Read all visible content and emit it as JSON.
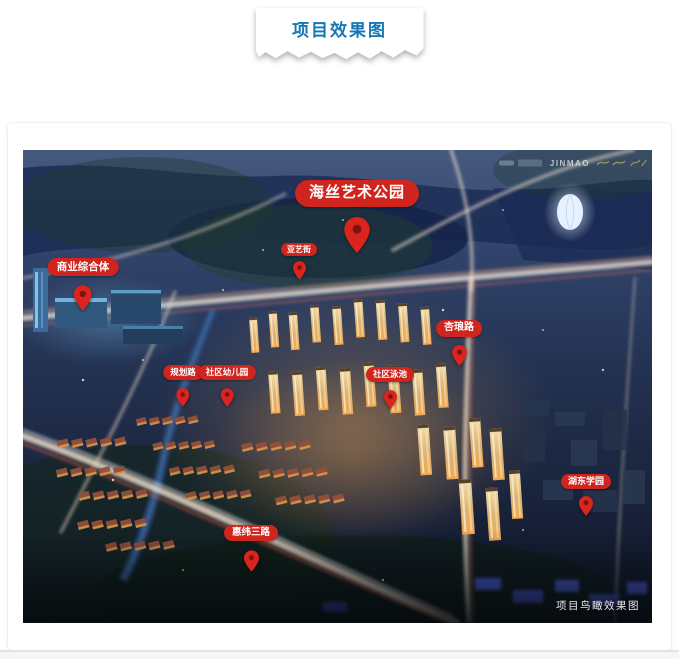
{
  "header": {
    "tab_label": "项目效果图",
    "accent_color": "#1577b2"
  },
  "rendering": {
    "watermark_brand": "JINMAO",
    "caption": "项目鸟瞰效果图",
    "pin_color": "#da251f",
    "badge_color": "#d0241e",
    "pins": [
      {
        "id": "haisi-art-park",
        "label": "海丝艺术公园"
      },
      {
        "id": "commercial-complex",
        "label": "商业综合体"
      },
      {
        "id": "yayi-street",
        "label": "亚艺街"
      },
      {
        "id": "xinglang-road",
        "label": "杏琅路"
      },
      {
        "id": "planned-road",
        "label": "规划路"
      },
      {
        "id": "community-kindergarten",
        "label": "社区幼儿园"
      },
      {
        "id": "community-pool",
        "label": "社区泳池"
      },
      {
        "id": "hudong-school",
        "label": "湖东学园"
      },
      {
        "id": "huiwei-3rd-road",
        "label": "惠纬三路"
      }
    ]
  }
}
